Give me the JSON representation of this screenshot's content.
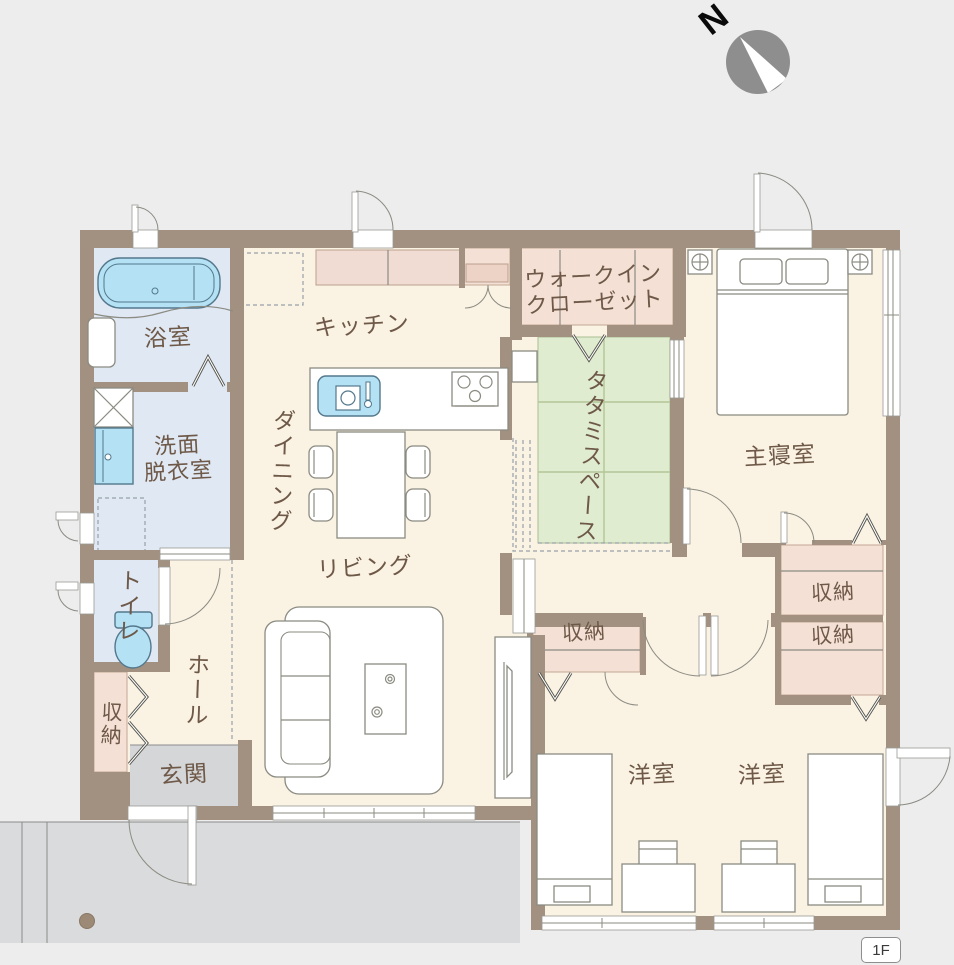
{
  "compass": {
    "north_label": "N"
  },
  "floor_badge": {
    "label": "1F"
  },
  "rooms": {
    "bathroom": {
      "label": "浴室"
    },
    "washroom": {
      "label_line1": "洗面",
      "label_line2": "脱衣室"
    },
    "toilet": {
      "label": "トイレ"
    },
    "entrance_storage": {
      "label": "収納"
    },
    "hall": {
      "label": "ホール"
    },
    "entrance": {
      "label": "玄関"
    },
    "kitchen": {
      "label": "キッチン"
    },
    "dining": {
      "label": "ダイニング"
    },
    "living": {
      "label": "リビング"
    },
    "walk_in_closet": {
      "label_line1": "ウォークイン",
      "label_line2": "クローゼット"
    },
    "tatami": {
      "label": "タタミスペース"
    },
    "master_bedroom": {
      "label": "主寝室"
    },
    "hall_storage": {
      "label": "収納"
    },
    "master_storage": {
      "label": "収納"
    },
    "kids_storage": {
      "label": "収納"
    },
    "western_room_1": {
      "label": "洋室"
    },
    "western_room_2": {
      "label": "洋室"
    }
  },
  "colors": {
    "bg": "#ededee",
    "wall": "#a29180",
    "floor": "#faf2e3",
    "wet": "#dfe8f3",
    "tatami": "#dfecd0",
    "closet": "#f5e0d6",
    "counter": "#f0dcd2",
    "entrance": "#d4d6d8",
    "porch": "#d9dbdc",
    "fixture": "#b5e1f5",
    "fixture_stroke": "#53788c",
    "label": "#6e5847",
    "line": "#8b8b82",
    "compass": "#8e8e8e"
  }
}
